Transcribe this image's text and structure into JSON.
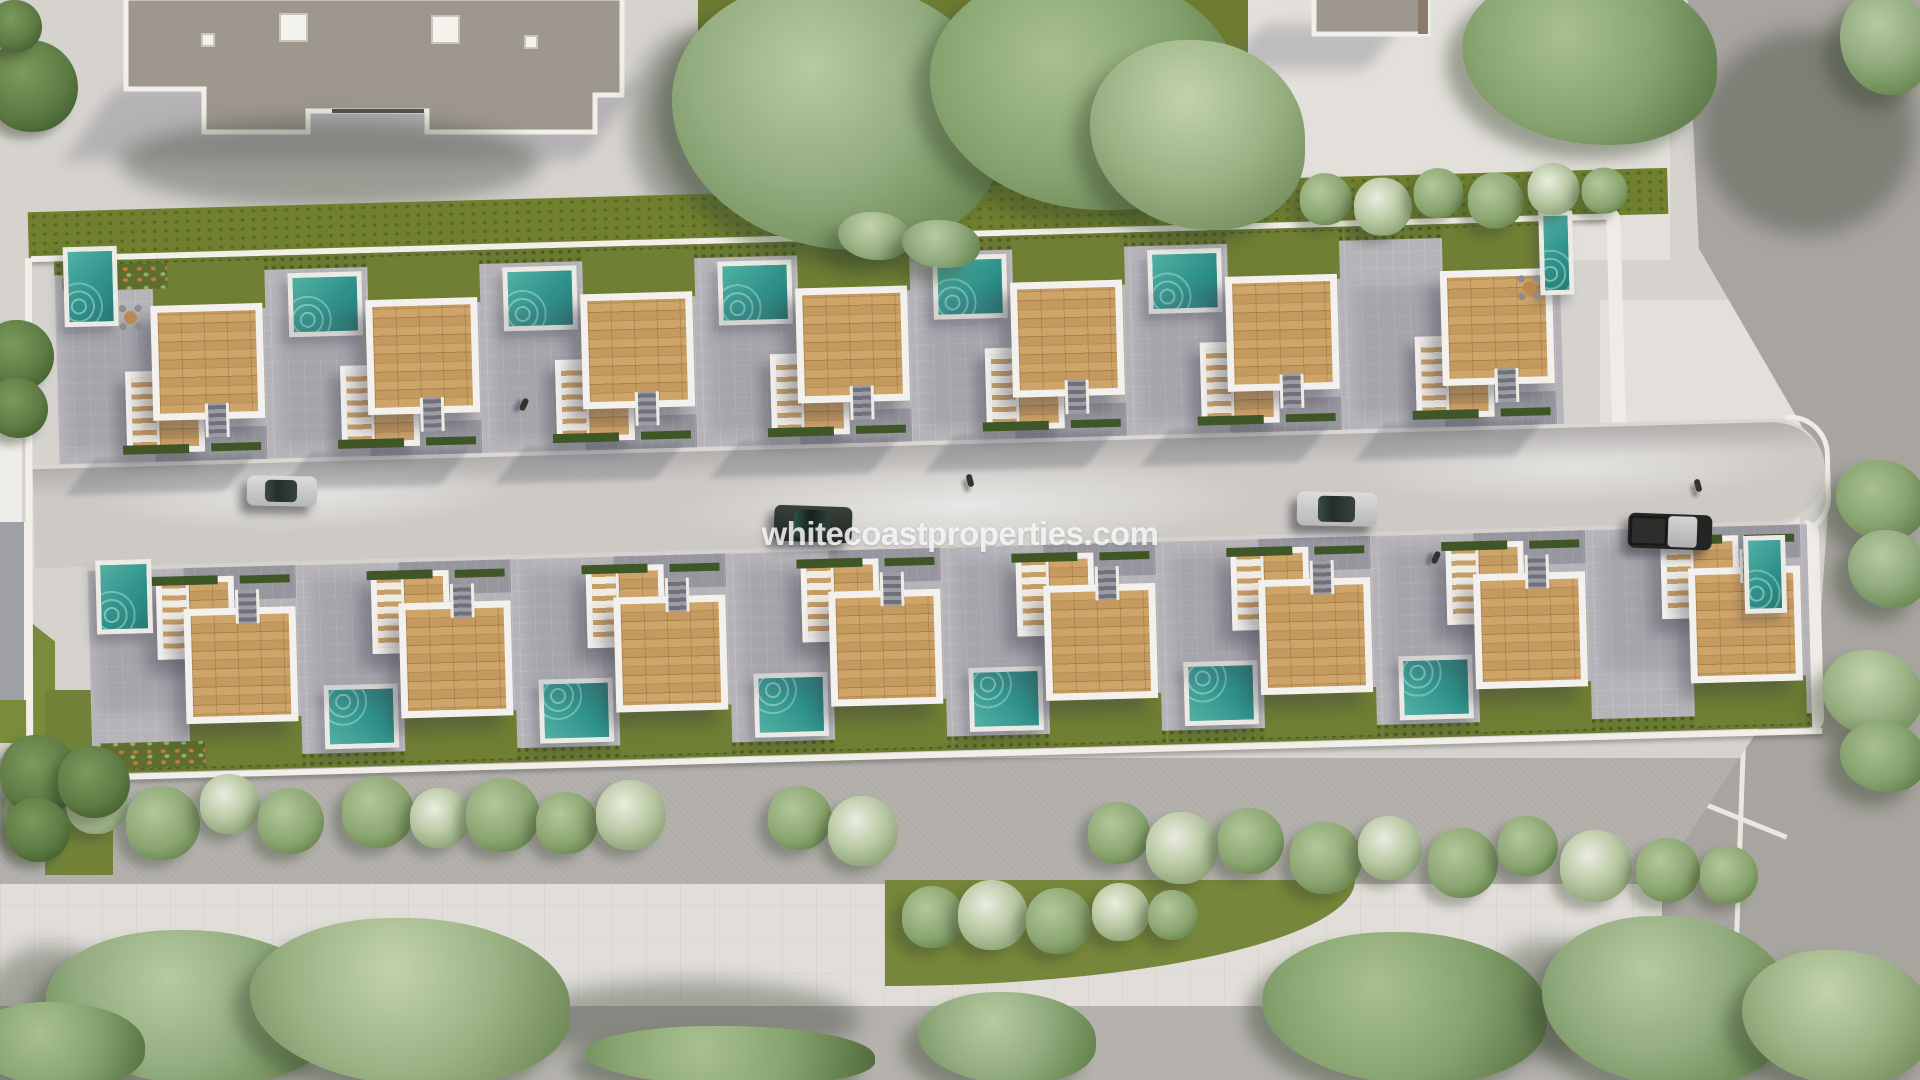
{
  "scene": {
    "description": "Aerial 3D render of a gated development of white villas with wooden roof terraces and private pools, a central street with parked cars, tree-lined sidewalks and surrounding roads",
    "watermark": "whitecoastproperties.com"
  },
  "palette": {
    "pool_teal": "#2f938b",
    "wood_deck": "#c3985f",
    "lawn_green": "#70802f",
    "white_structure": "#f2efe9",
    "patio_gray": "#b6b4b9",
    "street_gray": "#ccc9c5",
    "roof_gray": "#9e978d"
  },
  "site": {
    "rows": [
      {
        "name": "upper",
        "units": 7,
        "x0": 35,
        "pitch": 215,
        "pool_side": "top"
      },
      {
        "name": "lower",
        "units": 8,
        "x0": 60,
        "pitch": 215,
        "pool_side": "bottom"
      }
    ],
    "cap_pools": [
      {
        "x": 44,
        "y": 238,
        "w": 54,
        "h": 80
      },
      {
        "x": 1520,
        "y": 242,
        "w": 34,
        "h": 84
      },
      {
        "x": 68,
        "y": 552,
        "w": 56,
        "h": 74
      },
      {
        "x": 1716,
        "y": 572,
        "w": 42,
        "h": 78
      }
    ],
    "furniture": [
      {
        "x": 97,
        "y": 296
      },
      {
        "x": 1496,
        "y": 304
      }
    ]
  },
  "street": {
    "cars": [
      {
        "type": "silver",
        "x": 247,
        "y": 476,
        "w": 70,
        "h": 30,
        "angle": 1
      },
      {
        "type": "dark",
        "x": 774,
        "y": 506,
        "w": 78,
        "h": 36,
        "angle": 2
      },
      {
        "type": "silver",
        "x": 1297,
        "y": 492,
        "w": 80,
        "h": 34,
        "angle": 1
      },
      {
        "type": "pickup",
        "x": 1628,
        "y": 514,
        "w": 84,
        "h": 35,
        "angle": 2
      }
    ],
    "pedestrians": [
      {
        "x": 967,
        "y": 474
      },
      {
        "x": 1433,
        "y": 551
      },
      {
        "x": 1695,
        "y": 479
      },
      {
        "x": 521,
        "y": 398
      }
    ]
  },
  "vegetation": {
    "groups": [
      {
        "name": "sidewalk-trees",
        "layer": "canvas",
        "class": "bush",
        "items": [
          {
            "x": 4,
            "y": 778,
            "d": 70
          },
          {
            "x": 66,
            "y": 772,
            "d": 62,
            "blossom": true
          },
          {
            "x": 126,
            "y": 786,
            "d": 74
          },
          {
            "x": 200,
            "y": 774,
            "d": 60,
            "blossom": true
          },
          {
            "x": 258,
            "y": 788,
            "d": 66
          },
          {
            "x": 342,
            "y": 776,
            "d": 72
          },
          {
            "x": 410,
            "y": 788,
            "d": 60,
            "blossom": true
          },
          {
            "x": 466,
            "y": 778,
            "d": 74
          },
          {
            "x": 536,
            "y": 792,
            "d": 62
          },
          {
            "x": 596,
            "y": 780,
            "d": 70,
            "blossom": true
          },
          {
            "x": 768,
            "y": 786,
            "d": 64
          },
          {
            "x": 828,
            "y": 796,
            "d": 70,
            "blossom": true
          },
          {
            "x": 1088,
            "y": 802,
            "d": 62
          },
          {
            "x": 1146,
            "y": 812,
            "d": 72,
            "blossom": true
          },
          {
            "x": 1218,
            "y": 808,
            "d": 66
          },
          {
            "x": 1290,
            "y": 822,
            "d": 72
          },
          {
            "x": 1358,
            "y": 816,
            "d": 64,
            "blossom": true
          },
          {
            "x": 1428,
            "y": 828,
            "d": 70
          },
          {
            "x": 1498,
            "y": 816,
            "d": 60
          },
          {
            "x": 1560,
            "y": 830,
            "d": 72,
            "blossom": true
          },
          {
            "x": 1636,
            "y": 838,
            "d": 64
          },
          {
            "x": 1700,
            "y": 846,
            "d": 58
          }
        ]
      },
      {
        "name": "lawn-hedge-bushes",
        "layer": "dev",
        "class": "bush",
        "items": [
          {
            "x": 1282,
            "y": 8,
            "d": 52
          },
          {
            "x": 1336,
            "y": 14,
            "d": 58,
            "blossom": true
          },
          {
            "x": 1396,
            "y": 6,
            "d": 50
          },
          {
            "x": 1450,
            "y": 12,
            "d": 56
          },
          {
            "x": 1510,
            "y": 4,
            "d": 52,
            "blossom": true
          },
          {
            "x": 1564,
            "y": 10,
            "d": 46
          }
        ]
      },
      {
        "name": "wedge-bushes",
        "layer": "canvas",
        "class": "bush",
        "items": [
          {
            "x": 902,
            "y": 886,
            "d": 62
          },
          {
            "x": 958,
            "y": 880,
            "d": 70,
            "blossom": true
          },
          {
            "x": 1026,
            "y": 888,
            "d": 66
          },
          {
            "x": 1092,
            "y": 883,
            "d": 58,
            "blossom": true
          },
          {
            "x": 1148,
            "y": 890,
            "d": 50
          }
        ]
      },
      {
        "name": "median-trees",
        "layer": "canvas",
        "class": "tree-dark",
        "items": [
          {
            "x": 0,
            "y": 735,
            "d": 80
          },
          {
            "x": 58,
            "y": 746,
            "d": 72
          },
          {
            "x": 6,
            "y": 798,
            "d": 64
          }
        ]
      },
      {
        "name": "left-edge-trees",
        "layer": "canvas",
        "class": "tree-dark",
        "items": [
          {
            "x": -14,
            "y": 40,
            "d": 92
          },
          {
            "x": -10,
            "y": 0,
            "d": 52
          },
          {
            "x": -16,
            "y": 320,
            "d": 70
          },
          {
            "x": -12,
            "y": 378,
            "d": 60
          }
        ]
      },
      {
        "name": "top-center-trees",
        "layer": "canvas",
        "class": "tree-big",
        "items": [
          {
            "x": 672,
            "y": -20,
            "w": 330,
            "h": 270,
            "tone": "t1"
          },
          {
            "x": 930,
            "y": -30,
            "w": 310,
            "h": 240,
            "tone": "t2"
          },
          {
            "x": 1090,
            "y": 40,
            "w": 215,
            "h": 190,
            "tone": "t3"
          },
          {
            "x": 838,
            "y": 212,
            "w": 72,
            "h": 48,
            "tone": "t3"
          },
          {
            "x": 902,
            "y": 220,
            "w": 78,
            "h": 48,
            "tone": "t1"
          }
        ]
      },
      {
        "name": "top-right-trees",
        "layer": "canvas",
        "class": "tree-big",
        "items": [
          {
            "x": 1462,
            "y": -30,
            "w": 255,
            "h": 175,
            "tone": "t2"
          },
          {
            "x": 1840,
            "y": -10,
            "w": 90,
            "h": 105,
            "tone": "t1"
          }
        ]
      },
      {
        "name": "right-edge-trees",
        "layer": "canvas",
        "class": "tree-big",
        "items": [
          {
            "x": 1836,
            "y": 460,
            "w": 90,
            "h": 80,
            "tone": "t2"
          },
          {
            "x": 1848,
            "y": 530,
            "w": 80,
            "h": 78,
            "tone": "t1"
          },
          {
            "x": 1822,
            "y": 650,
            "w": 100,
            "h": 86,
            "tone": "t3"
          },
          {
            "x": 1840,
            "y": 722,
            "w": 86,
            "h": 70,
            "tone": "t2"
          }
        ]
      },
      {
        "name": "bottom-trees",
        "layer": "canvas",
        "class": "tree-big",
        "items": [
          {
            "x": 46,
            "y": 930,
            "w": 290,
            "h": 155,
            "tone": "t1"
          },
          {
            "x": 250,
            "y": 918,
            "w": 320,
            "h": 168,
            "tone": "t3"
          },
          {
            "x": 585,
            "y": 1026,
            "w": 290,
            "h": 60,
            "tone": "t2"
          },
          {
            "x": 918,
            "y": 992,
            "w": 178,
            "h": 92,
            "tone": "t1"
          },
          {
            "x": 1262,
            "y": 932,
            "w": 285,
            "h": 152,
            "tone": "t2"
          },
          {
            "x": 1542,
            "y": 916,
            "w": 250,
            "h": 170,
            "tone": "t1"
          },
          {
            "x": 1742,
            "y": 950,
            "w": 190,
            "h": 135,
            "tone": "t3"
          },
          {
            "x": -30,
            "y": 1002,
            "w": 175,
            "h": 85,
            "tone": "t2"
          }
        ]
      },
      {
        "name": "shadow-blobs",
        "layer": "canvas",
        "class": "shade",
        "items": [
          {
            "x": 630,
            "y": 30,
            "w": 130,
            "h": 190
          },
          {
            "x": 755,
            "y": 120,
            "w": 340,
            "h": 140
          },
          {
            "x": 1700,
            "y": 30,
            "w": 215,
            "h": 205
          },
          {
            "x": -20,
            "y": 945,
            "w": 140,
            "h": 140
          },
          {
            "x": 520,
            "y": 980,
            "w": 340,
            "h": 80
          },
          {
            "x": 1480,
            "y": 940,
            "w": 130,
            "h": 120
          },
          {
            "x": 120,
            "y": 118,
            "w": 420,
            "h": 90
          }
        ]
      }
    ]
  }
}
